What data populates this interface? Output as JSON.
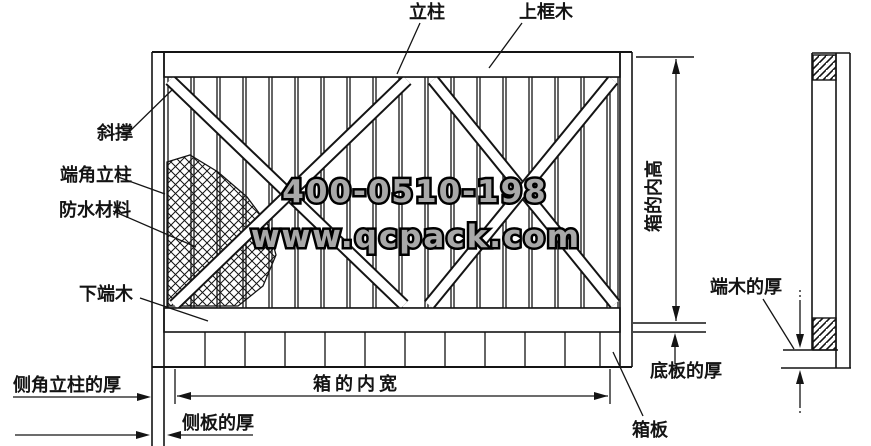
{
  "watermark": {
    "phone": "400-0510-198",
    "website": "www.qcpack.com"
  },
  "labels": {
    "vertical_post": "立柱",
    "top_frame_wood": "上框木",
    "diagonal_brace": "斜撑",
    "end_corner_post": "端角立柱",
    "waterproof_material": "防水材料",
    "bottom_end_wood": "下端木",
    "side_corner_post_thickness": "侧角立柱的厚",
    "side_plank_thickness": "侧板的厚",
    "box_inner_width": "箱的内宽",
    "box_plank": "箱板",
    "box_inner_height": "箱的内高",
    "bottom_plank_thickness": "底板的厚",
    "end_wood_thickness": "端木的厚"
  },
  "colors": {
    "line": "#141414",
    "background": "#ffffff",
    "watermark_fill": "#a8a8a8",
    "watermark_outline": "#000000"
  }
}
